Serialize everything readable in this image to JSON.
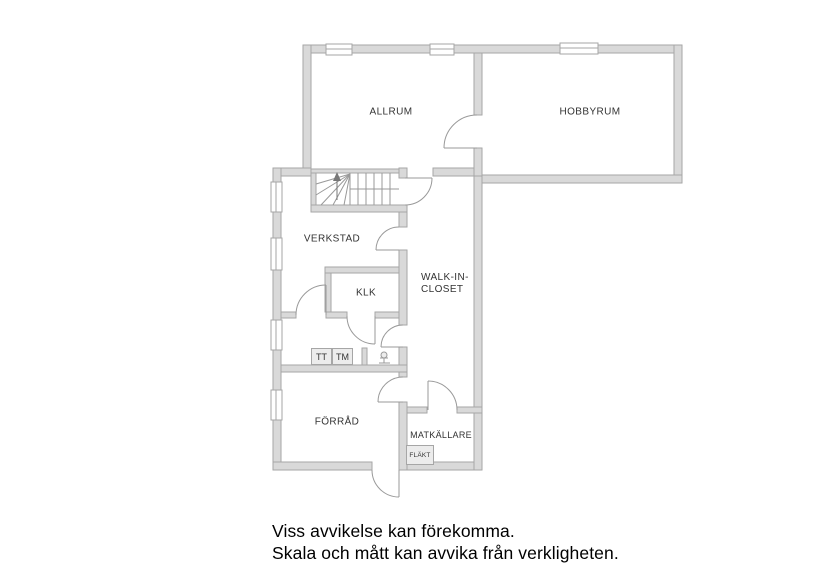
{
  "rooms": {
    "allrum": "ALLRUM",
    "hobbyrum": "HOBBYRUM",
    "verkstad": "VERKSTAD",
    "klk": "KLK",
    "walk_in_closet_line1": "WALK-IN-",
    "walk_in_closet_line2": "CLOSET",
    "forrad": "FÖRRÅD",
    "matkallare": "MATKÄLLARE"
  },
  "fixtures": {
    "tt": "TT",
    "tm": "TM",
    "flakt": "FLÄKT"
  },
  "footer": {
    "line1": "Viss avvikelse kan förekomma.",
    "line2": "Skala och mått kan avvika från verkligheten."
  },
  "colors": {
    "wall_fill": "#d9d9d9",
    "wall_stroke": "#a6a6a6",
    "thin_line": "#999999",
    "label_text": "#333333",
    "footer_text": "#000000",
    "appliance_fill": "#ececec"
  }
}
